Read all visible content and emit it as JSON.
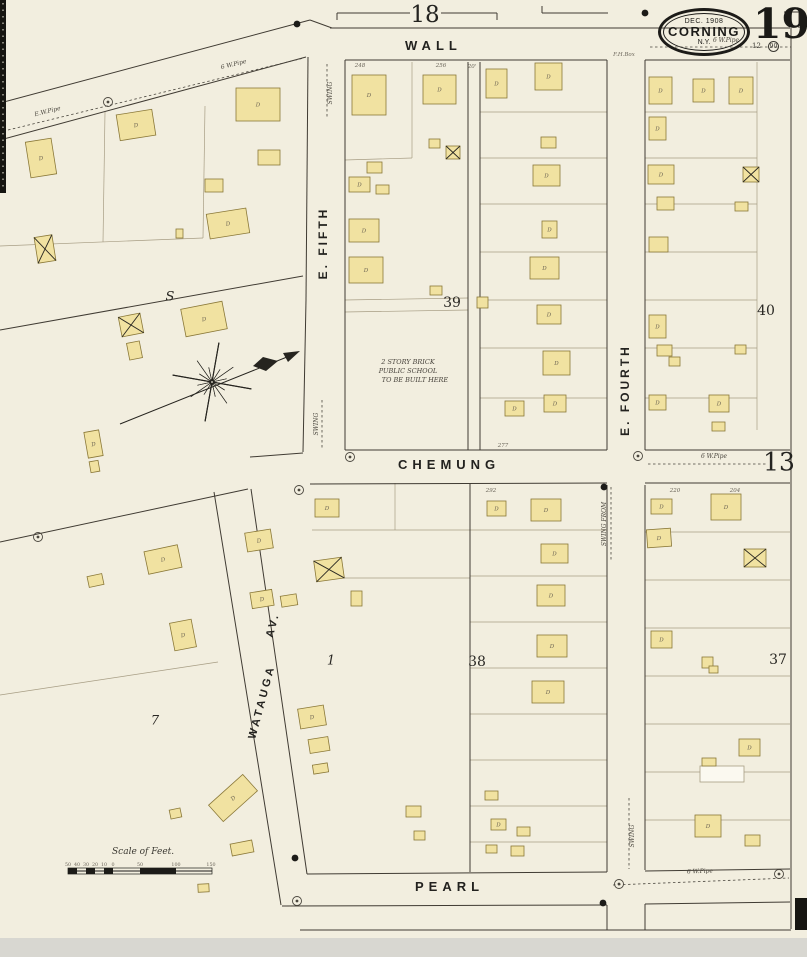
{
  "sheet": {
    "number": "19",
    "date": "DEC. 1908",
    "city": "CORNING",
    "state": "N.Y.",
    "adjacent_top": "18",
    "adjacent_right": "13",
    "corner_marks": [
      "12",
      "90"
    ]
  },
  "streets": {
    "wall": "WALL",
    "chemung": "CHEMUNG",
    "pearl": "PEARL",
    "e_fifth": "E. FIFTH",
    "e_fourth": "E. FOURTH",
    "watauga": "WATAUGA",
    "watauga_av": "AV."
  },
  "notes": {
    "school": [
      "2 STORY BRICK",
      "PUBLIC SCHOOL",
      "TO BE BUILT HERE"
    ],
    "scale": "Scale of Feet."
  },
  "blocks": [
    {
      "label": "39",
      "x": 452,
      "y": 303,
      "italic": false
    },
    {
      "label": "40",
      "x": 766,
      "y": 311,
      "italic": false
    },
    {
      "label": "38",
      "x": 477,
      "y": 662,
      "italic": false
    },
    {
      "label": "37",
      "x": 778,
      "y": 660,
      "italic": false
    },
    {
      "label": "7",
      "x": 155,
      "y": 721,
      "italic": true
    },
    {
      "label": "1",
      "x": 331,
      "y": 661,
      "italic": true
    },
    {
      "label": "S",
      "x": 170,
      "y": 297,
      "italic": true
    }
  ],
  "scale_ticks": [
    {
      "t": "50",
      "x": 68
    },
    {
      "t": "40",
      "x": 77
    },
    {
      "t": "30",
      "x": 86
    },
    {
      "t": "20",
      "x": 95
    },
    {
      "t": "10",
      "x": 104
    },
    {
      "t": "0",
      "x": 113
    },
    {
      "t": "50",
      "x": 140
    },
    {
      "t": "100",
      "x": 176
    },
    {
      "t": "150",
      "x": 211
    }
  ],
  "tiny_labels": [
    {
      "t": "248",
      "x": 360,
      "y": 67,
      "r": 0
    },
    {
      "t": "256",
      "x": 441,
      "y": 67,
      "r": 0
    },
    {
      "t": "20'",
      "x": 472,
      "y": 68,
      "r": 0
    },
    {
      "t": "277",
      "x": 503,
      "y": 447,
      "r": 0
    },
    {
      "t": "292",
      "x": 491,
      "y": 492,
      "r": 0
    },
    {
      "t": "220",
      "x": 675,
      "y": 492,
      "r": 0
    },
    {
      "t": "204",
      "x": 735,
      "y": 492,
      "r": 0
    },
    {
      "t": "F.H.Box",
      "x": 624,
      "y": 56,
      "r": 0
    }
  ],
  "pipes": [
    {
      "points": [
        [
          8,
          130
        ],
        [
          304,
          58
        ]
      ],
      "labels": [
        {
          "t": "E.W.Pipe",
          "x": 48,
          "y": 113,
          "r": -14
        },
        {
          "t": "6 W.Pipe",
          "x": 234,
          "y": 66,
          "r": -14
        }
      ]
    },
    {
      "points": [
        [
          650,
          47
        ],
        [
          791,
          47
        ]
      ],
      "labels": [
        {
          "t": "6 W.Pipe",
          "x": 726,
          "y": 42,
          "r": 0
        }
      ]
    },
    {
      "points": [
        [
          648,
          464
        ],
        [
          768,
          464
        ]
      ],
      "labels": [
        {
          "t": "6 W.Pipe",
          "x": 714,
          "y": 458,
          "r": 0
        }
      ]
    },
    {
      "points": [
        [
          613,
          885
        ],
        [
          789,
          878
        ]
      ],
      "labels": [
        {
          "t": "6 W.Pipe",
          "x": 700,
          "y": 873,
          "r": -2
        }
      ]
    },
    {
      "points": [
        [
          611,
          487
        ],
        [
          611,
          562
        ]
      ],
      "labels": [
        {
          "t": "SWING FROM",
          "x": 606,
          "y": 524,
          "r": -90
        }
      ]
    },
    {
      "points": [
        [
          629,
          798
        ],
        [
          629,
          869
        ]
      ],
      "labels": [
        {
          "t": "SWING",
          "x": 634,
          "y": 836,
          "r": -90
        }
      ]
    },
    {
      "points": [
        [
          327,
          64
        ],
        [
          327,
          118
        ]
      ],
      "labels": [
        {
          "t": "SWING",
          "x": 332,
          "y": 93,
          "r": -90
        }
      ]
    },
    {
      "points": [
        [
          322,
          400
        ],
        [
          322,
          448
        ]
      ],
      "labels": [
        {
          "t": "SWING",
          "x": 318,
          "y": 424,
          "r": -90
        }
      ]
    }
  ],
  "rings": [
    [
      108,
      102
    ],
    [
      350,
      457
    ],
    [
      638,
      456
    ],
    [
      619,
      884
    ],
    [
      779,
      874
    ],
    [
      297,
      901
    ],
    [
      38,
      537
    ],
    [
      299,
      490
    ]
  ],
  "dots": [
    [
      297,
      24
    ],
    [
      645,
      13
    ],
    [
      604,
      487
    ],
    [
      295,
      858
    ],
    [
      603,
      903
    ]
  ],
  "roads": [
    [
      0,
      103,
      310,
      20
    ],
    [
      0,
      140,
      306,
      57
    ],
    [
      310,
      20,
      332,
      28
    ],
    [
      330,
      28,
      790,
      28
    ],
    [
      345,
      60,
      607,
      60
    ],
    [
      645,
      60,
      790,
      60
    ],
    [
      308,
      57,
      306,
      300
    ],
    [
      306,
      300,
      303,
      452
    ],
    [
      345,
      60,
      345,
      450
    ],
    [
      607,
      60,
      607,
      450
    ],
    [
      645,
      60,
      645,
      450
    ],
    [
      607,
      485,
      607,
      872
    ],
    [
      645,
      485,
      645,
      870
    ],
    [
      607,
      905,
      607,
      930
    ],
    [
      645,
      904,
      645,
      930
    ],
    [
      250,
      457,
      303,
      453
    ],
    [
      345,
      450,
      607,
      450
    ],
    [
      645,
      450,
      790,
      450
    ],
    [
      310,
      484,
      607,
      483
    ],
    [
      645,
      483,
      790,
      483
    ],
    [
      0,
      542,
      248,
      489
    ],
    [
      214,
      492,
      281,
      905
    ],
    [
      251,
      489,
      307,
      874
    ],
    [
      307,
      874,
      607,
      872
    ],
    [
      645,
      871,
      790,
      869
    ],
    [
      282,
      906,
      607,
      905
    ],
    [
      645,
      904,
      790,
      902
    ],
    [
      0,
      330,
      303,
      276
    ],
    [
      791,
      28,
      791,
      929
    ],
    [
      300,
      930,
      791,
      930
    ],
    [
      337,
      13,
      410,
      13
    ],
    [
      441,
      13,
      497,
      13
    ],
    [
      337,
      13,
      337,
      20
    ],
    [
      497,
      13,
      497,
      20
    ],
    [
      542,
      6,
      542,
      13
    ],
    [
      542,
      13,
      608,
      13
    ],
    [
      784,
      12,
      799,
      12
    ],
    [
      799,
      12,
      799,
      28
    ],
    [
      468,
      62,
      468,
      450
    ],
    [
      480,
      62,
      480,
      450
    ],
    [
      470,
      483,
      470,
      872
    ]
  ],
  "lot_lines": [
    [
      480,
      112,
      607,
      112
    ],
    [
      480,
      158,
      607,
      158
    ],
    [
      480,
      204,
      607,
      204
    ],
    [
      480,
      252,
      607,
      252
    ],
    [
      480,
      300,
      607,
      300
    ],
    [
      480,
      348,
      607,
      348
    ],
    [
      480,
      398,
      607,
      398
    ],
    [
      645,
      112,
      757,
      112
    ],
    [
      645,
      158,
      757,
      158
    ],
    [
      645,
      204,
      757,
      204
    ],
    [
      645,
      252,
      757,
      252
    ],
    [
      645,
      300,
      757,
      300
    ],
    [
      645,
      348,
      757,
      348
    ],
    [
      645,
      398,
      757,
      398
    ],
    [
      757,
      62,
      757,
      430
    ],
    [
      345,
      160,
      412,
      158
    ],
    [
      412,
      62,
      412,
      158
    ],
    [
      345,
      300,
      468,
      298
    ],
    [
      345,
      312,
      468,
      310
    ],
    [
      470,
      530,
      607,
      530
    ],
    [
      470,
      576,
      607,
      576
    ],
    [
      470,
      622,
      607,
      622
    ],
    [
      470,
      668,
      607,
      668
    ],
    [
      470,
      714,
      607,
      714
    ],
    [
      470,
      760,
      607,
      760
    ],
    [
      470,
      806,
      607,
      806
    ],
    [
      470,
      842,
      607,
      842
    ],
    [
      645,
      532,
      790,
      532
    ],
    [
      645,
      580,
      790,
      580
    ],
    [
      645,
      628,
      790,
      628
    ],
    [
      645,
      676,
      790,
      676
    ],
    [
      645,
      724,
      790,
      724
    ],
    [
      645,
      772,
      790,
      772
    ],
    [
      645,
      820,
      790,
      820
    ],
    [
      312,
      530,
      470,
      530
    ],
    [
      318,
      578,
      470,
      578
    ],
    [
      395,
      483,
      395,
      530
    ],
    [
      105,
      112,
      103,
      242
    ],
    [
      205,
      106,
      203,
      238
    ],
    [
      0,
      246,
      203,
      238
    ],
    [
      0,
      695,
      218,
      662
    ]
  ],
  "buildings": [
    [
      28,
      140,
      26,
      36,
      -9,
      "D",
      ""
    ],
    [
      118,
      112,
      36,
      26,
      -9,
      "D",
      ""
    ],
    [
      236,
      88,
      44,
      33,
      0,
      "D",
      ""
    ],
    [
      258,
      150,
      22,
      15,
      0,
      "",
      ""
    ],
    [
      205,
      179,
      18,
      13,
      0,
      "",
      ""
    ],
    [
      208,
      211,
      40,
      25,
      -9,
      "D",
      ""
    ],
    [
      176,
      229,
      7,
      9,
      0,
      "",
      ""
    ],
    [
      36,
      236,
      18,
      26,
      -9,
      "",
      "x"
    ],
    [
      120,
      315,
      22,
      20,
      -11,
      "",
      "x"
    ],
    [
      128,
      342,
      13,
      17,
      -11,
      "",
      ""
    ],
    [
      183,
      305,
      42,
      28,
      -11,
      "D",
      ""
    ],
    [
      86,
      431,
      15,
      26,
      -10,
      "D",
      ""
    ],
    [
      90,
      461,
      9,
      11,
      -10,
      "",
      ""
    ],
    [
      146,
      548,
      34,
      23,
      -12,
      "D",
      ""
    ],
    [
      88,
      575,
      15,
      11,
      -12,
      "",
      ""
    ],
    [
      172,
      621,
      22,
      28,
      -11,
      "D",
      ""
    ],
    [
      210,
      787,
      46,
      22,
      -42,
      "D",
      ""
    ],
    [
      170,
      809,
      11,
      9,
      -12,
      "",
      ""
    ],
    [
      231,
      842,
      22,
      12,
      -11,
      "",
      ""
    ],
    [
      198,
      884,
      11,
      8,
      -3,
      "",
      ""
    ],
    [
      246,
      531,
      26,
      19,
      -9,
      "D",
      ""
    ],
    [
      315,
      499,
      24,
      18,
      0,
      "D",
      ""
    ],
    [
      315,
      559,
      28,
      21,
      -8,
      "",
      "x"
    ],
    [
      251,
      591,
      22,
      16,
      -9,
      "D",
      ""
    ],
    [
      281,
      595,
      16,
      11,
      -9,
      "",
      ""
    ],
    [
      351,
      591,
      11,
      15,
      0,
      "",
      ""
    ],
    [
      299,
      707,
      26,
      20,
      -9,
      "D",
      ""
    ],
    [
      309,
      738,
      20,
      14,
      -9,
      "",
      ""
    ],
    [
      313,
      764,
      15,
      9,
      -9,
      "",
      ""
    ],
    [
      406,
      806,
      15,
      11,
      0,
      "",
      ""
    ],
    [
      414,
      831,
      11,
      9,
      0,
      "",
      ""
    ],
    [
      487,
      501,
      19,
      15,
      0,
      "D",
      ""
    ],
    [
      531,
      499,
      30,
      22,
      0,
      "D",
      ""
    ],
    [
      541,
      544,
      27,
      19,
      0,
      "D",
      ""
    ],
    [
      537,
      585,
      28,
      21,
      0,
      "D",
      ""
    ],
    [
      537,
      635,
      30,
      22,
      0,
      "D",
      ""
    ],
    [
      532,
      681,
      32,
      22,
      0,
      "D",
      ""
    ],
    [
      485,
      791,
      13,
      9,
      0,
      "",
      ""
    ],
    [
      491,
      819,
      15,
      11,
      0,
      "D",
      ""
    ],
    [
      517,
      827,
      13,
      9,
      0,
      "",
      ""
    ],
    [
      486,
      845,
      11,
      8,
      0,
      "",
      ""
    ],
    [
      511,
      846,
      13,
      10,
      0,
      "",
      ""
    ],
    [
      352,
      75,
      34,
      40,
      0,
      "D",
      ""
    ],
    [
      423,
      75,
      33,
      29,
      0,
      "D",
      ""
    ],
    [
      367,
      162,
      15,
      11,
      0,
      "",
      ""
    ],
    [
      349,
      177,
      21,
      15,
      0,
      "D",
      ""
    ],
    [
      376,
      185,
      13,
      9,
      0,
      "",
      ""
    ],
    [
      429,
      139,
      11,
      9,
      0,
      "",
      ""
    ],
    [
      446,
      146,
      14,
      13,
      0,
      "",
      "x"
    ],
    [
      349,
      219,
      30,
      23,
      0,
      "D",
      ""
    ],
    [
      349,
      257,
      34,
      26,
      0,
      "D",
      ""
    ],
    [
      477,
      297,
      11,
      11,
      0,
      "",
      ""
    ],
    [
      430,
      286,
      12,
      9,
      0,
      "",
      ""
    ],
    [
      486,
      69,
      21,
      29,
      0,
      "D",
      ""
    ],
    [
      535,
      63,
      27,
      27,
      0,
      "D",
      ""
    ],
    [
      541,
      137,
      15,
      11,
      0,
      "",
      ""
    ],
    [
      533,
      165,
      27,
      21,
      0,
      "D",
      ""
    ],
    [
      542,
      221,
      15,
      17,
      0,
      "D",
      ""
    ],
    [
      530,
      257,
      29,
      22,
      0,
      "D",
      ""
    ],
    [
      537,
      305,
      24,
      19,
      0,
      "D",
      ""
    ],
    [
      543,
      351,
      27,
      24,
      0,
      "D",
      ""
    ],
    [
      505,
      401,
      19,
      15,
      0,
      "D",
      ""
    ],
    [
      544,
      395,
      22,
      17,
      0,
      "D",
      ""
    ],
    [
      649,
      77,
      23,
      27,
      0,
      "D",
      ""
    ],
    [
      693,
      79,
      21,
      23,
      0,
      "D",
      ""
    ],
    [
      729,
      77,
      24,
      27,
      0,
      "D",
      ""
    ],
    [
      649,
      117,
      17,
      23,
      0,
      "D",
      ""
    ],
    [
      648,
      165,
      26,
      19,
      0,
      "D",
      ""
    ],
    [
      743,
      167,
      16,
      15,
      0,
      "",
      "x"
    ],
    [
      657,
      197,
      17,
      13,
      0,
      "",
      ""
    ],
    [
      735,
      202,
      13,
      9,
      0,
      "",
      ""
    ],
    [
      649,
      237,
      19,
      15,
      0,
      "",
      ""
    ],
    [
      649,
      315,
      17,
      23,
      0,
      "D",
      ""
    ],
    [
      657,
      345,
      15,
      11,
      0,
      "",
      ""
    ],
    [
      669,
      357,
      11,
      9,
      0,
      "",
      ""
    ],
    [
      735,
      345,
      11,
      9,
      0,
      "",
      ""
    ],
    [
      649,
      395,
      17,
      15,
      0,
      "D",
      ""
    ],
    [
      709,
      395,
      20,
      17,
      0,
      "D",
      ""
    ],
    [
      712,
      422,
      13,
      9,
      0,
      "",
      ""
    ],
    [
      651,
      499,
      21,
      15,
      0,
      "D",
      ""
    ],
    [
      711,
      494,
      30,
      26,
      0,
      "D",
      ""
    ],
    [
      647,
      529,
      24,
      18,
      -4,
      "D",
      ""
    ],
    [
      744,
      549,
      22,
      18,
      0,
      "",
      "x"
    ],
    [
      651,
      631,
      21,
      17,
      0,
      "D",
      ""
    ],
    [
      702,
      657,
      11,
      11,
      0,
      "",
      ""
    ],
    [
      709,
      666,
      9,
      7,
      0,
      "",
      ""
    ],
    [
      739,
      739,
      21,
      17,
      0,
      "D",
      ""
    ],
    [
      700,
      766,
      44,
      16,
      0,
      "",
      "w"
    ],
    [
      702,
      758,
      14,
      8,
      0,
      "",
      ""
    ],
    [
      695,
      815,
      26,
      22,
      0,
      "D",
      ""
    ],
    [
      745,
      835,
      15,
      11,
      0,
      "",
      ""
    ]
  ],
  "compass": {
    "cx": 212,
    "cy": 382
  },
  "colors": {
    "paper": "#f2eedf",
    "road": "#403b33",
    "lot": "#a79d84",
    "building_fill": "#f1e2a1",
    "building_stroke": "#8a7838",
    "white_fill": "#fbf9f0",
    "pipe": "#4a463e",
    "ink": "#1c1b18",
    "tiny_text": "#6b655a",
    "dwelling_text": "#6b6352",
    "edge_black": "#161511",
    "bottom_strip": "#d8d7d1"
  }
}
